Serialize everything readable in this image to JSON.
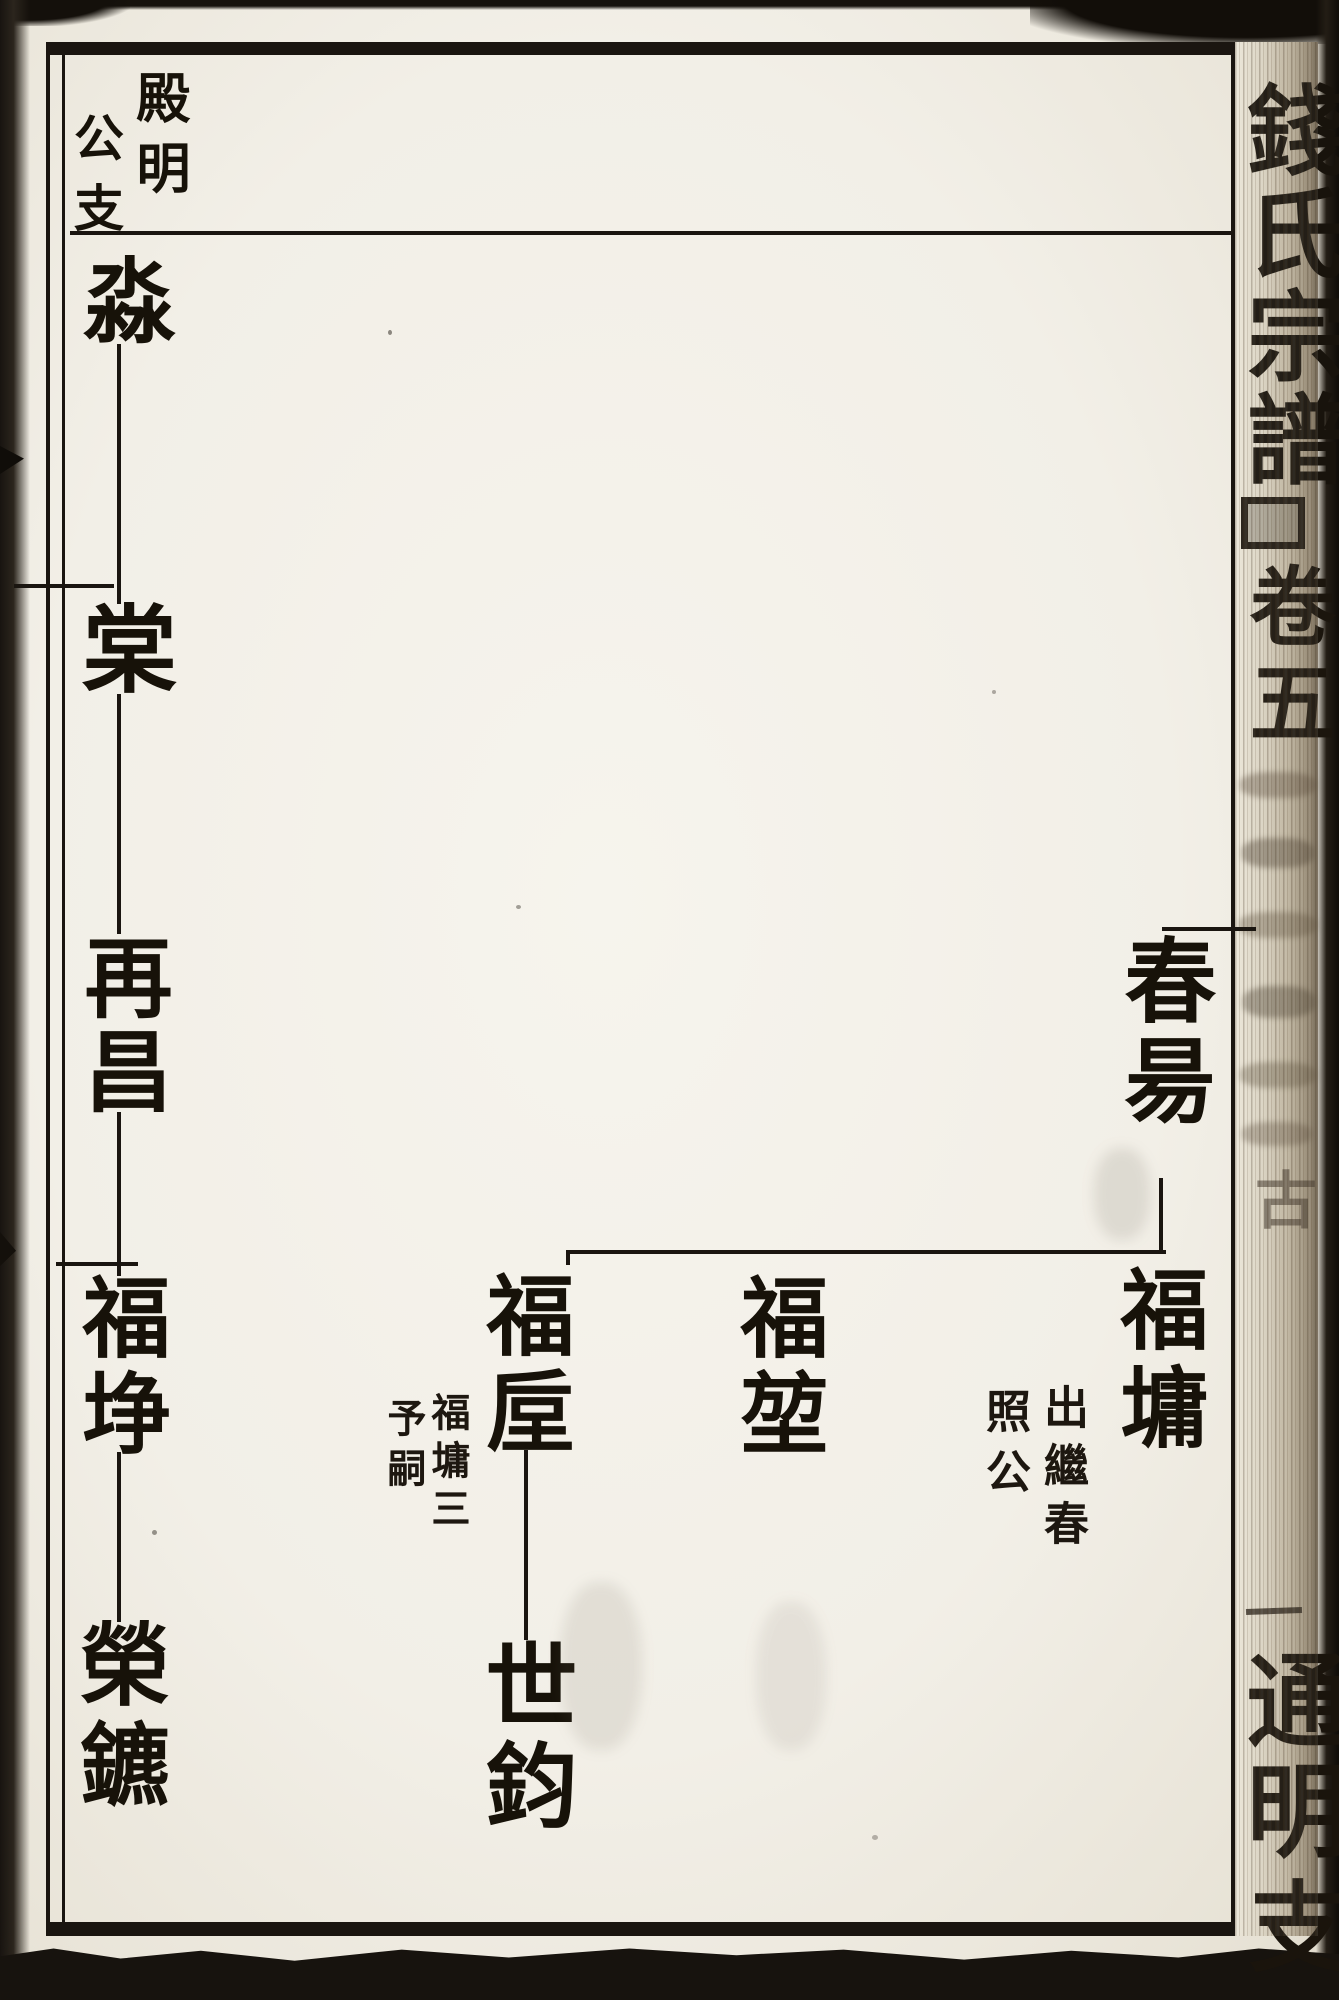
{
  "header": {
    "branch_title_right": "殿明",
    "branch_title_left": "公支"
  },
  "spine": {
    "title": "錢氏宗譜",
    "volume": "卷五",
    "faint_char": "古",
    "bottom_chars": "通明",
    "bottom_partial_char": "支"
  },
  "lineage": {
    "trunk": [
      "淼",
      "棠",
      "再昌",
      "福埩",
      "榮鑣"
    ],
    "branch": {
      "parent": "春昜",
      "child_left": "福垕",
      "child_middle": "福堃",
      "child_right": "福墉",
      "grandchild": "世鈞"
    },
    "notes": {
      "under_child_left": {
        "col_right": "福墉三",
        "col_left": "予嗣"
      },
      "under_child_right": {
        "col_right": "出繼春",
        "col_left": "照公"
      }
    }
  }
}
